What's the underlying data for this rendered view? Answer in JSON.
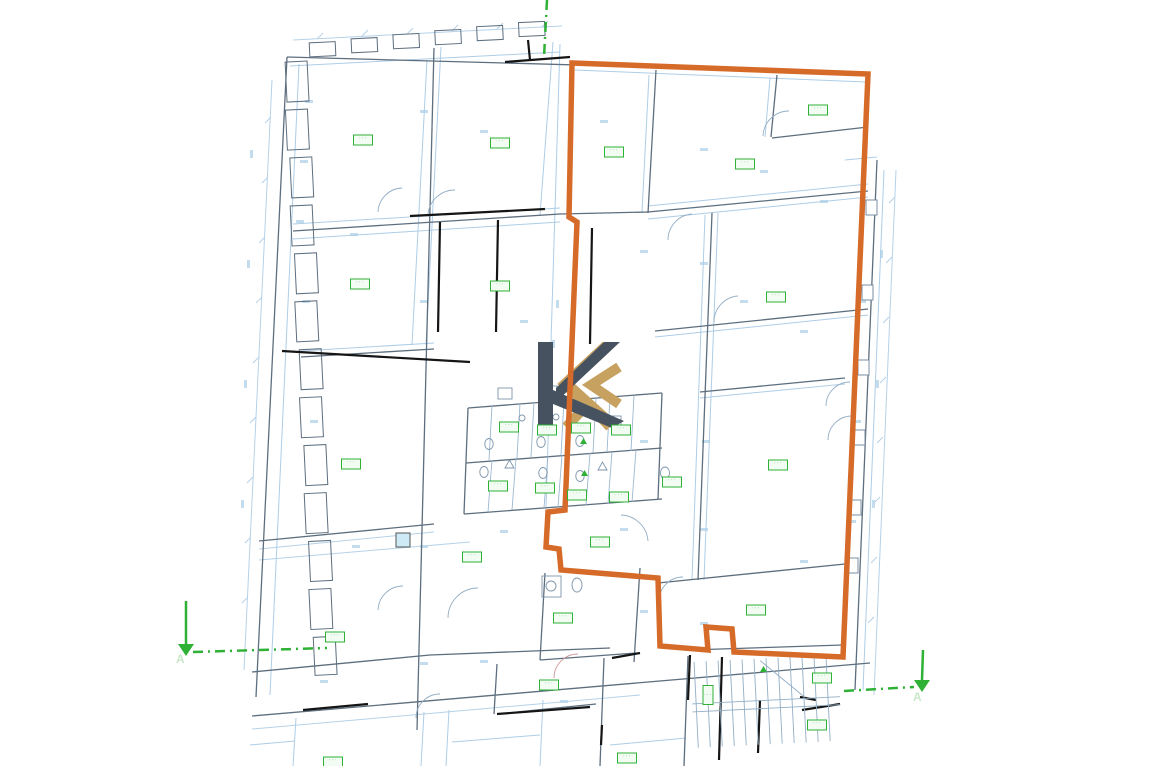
{
  "title": "Architectural floor plan with highlighted unit outline",
  "canvas": {
    "width": 1152,
    "height": 766,
    "background": "#ffffff"
  },
  "plan": {
    "type": "architectural-floor-plan",
    "colors": {
      "highlight_outline": "#d66a28",
      "plan_line_light": "#aecde6",
      "plan_line_medium": "#7d96ab",
      "wall_gray": "#5d6e7e",
      "wall_black": "#151515",
      "annotation_green": "#2eb135",
      "annotation_green_faint": "#c9e8c9",
      "fixture_blue": "#7e95ab",
      "logo_dark": "#475260",
      "logo_gold": "#c6a15f",
      "cyan_fill": "#cfeaf7"
    }
  },
  "section_markers": {
    "top": {
      "x1": 547,
      "y1": 0,
      "x2": 544,
      "y2": 57
    },
    "left": {
      "label": "A",
      "arrow": {
        "x1": 186,
        "y1": 601,
        "x2": 186,
        "y2": 644
      },
      "line": {
        "x1": 193,
        "y1": 652,
        "x2": 327,
        "y2": 648
      },
      "label_pos": {
        "x": 176,
        "y": 652
      }
    },
    "right": {
      "label": "A",
      "arrow": {
        "x1": 923,
        "y1": 650,
        "x2": 922,
        "y2": 680
      },
      "line": {
        "x1": 844,
        "y1": 691,
        "x2": 914,
        "y2": 687
      },
      "label_pos": {
        "x": 913,
        "y": 690
      }
    }
  },
  "room_labels": {
    "glyph": "···",
    "boxes": [
      {
        "x": 363,
        "y": 140
      },
      {
        "x": 500,
        "y": 143
      },
      {
        "x": 614,
        "y": 152
      },
      {
        "x": 745,
        "y": 164
      },
      {
        "x": 818,
        "y": 110
      },
      {
        "x": 360,
        "y": 284
      },
      {
        "x": 500,
        "y": 286
      },
      {
        "x": 776,
        "y": 297
      },
      {
        "x": 351,
        "y": 464
      },
      {
        "x": 778,
        "y": 465
      },
      {
        "x": 509,
        "y": 427
      },
      {
        "x": 547,
        "y": 430
      },
      {
        "x": 581,
        "y": 428
      },
      {
        "x": 621,
        "y": 430
      },
      {
        "x": 498,
        "y": 486
      },
      {
        "x": 545,
        "y": 488
      },
      {
        "x": 577,
        "y": 495
      },
      {
        "x": 619,
        "y": 497
      },
      {
        "x": 672,
        "y": 482
      },
      {
        "x": 600,
        "y": 542
      },
      {
        "x": 472,
        "y": 557
      },
      {
        "x": 563,
        "y": 618
      },
      {
        "x": 549,
        "y": 685
      },
      {
        "x": 335,
        "y": 637
      },
      {
        "x": 756,
        "y": 610
      },
      {
        "x": 822,
        "y": 678
      },
      {
        "x": 817,
        "y": 725
      },
      {
        "x": 333,
        "y": 762
      },
      {
        "x": 627,
        "y": 758
      },
      {
        "x": 708,
        "y": 695,
        "vertical": true
      }
    ]
  }
}
